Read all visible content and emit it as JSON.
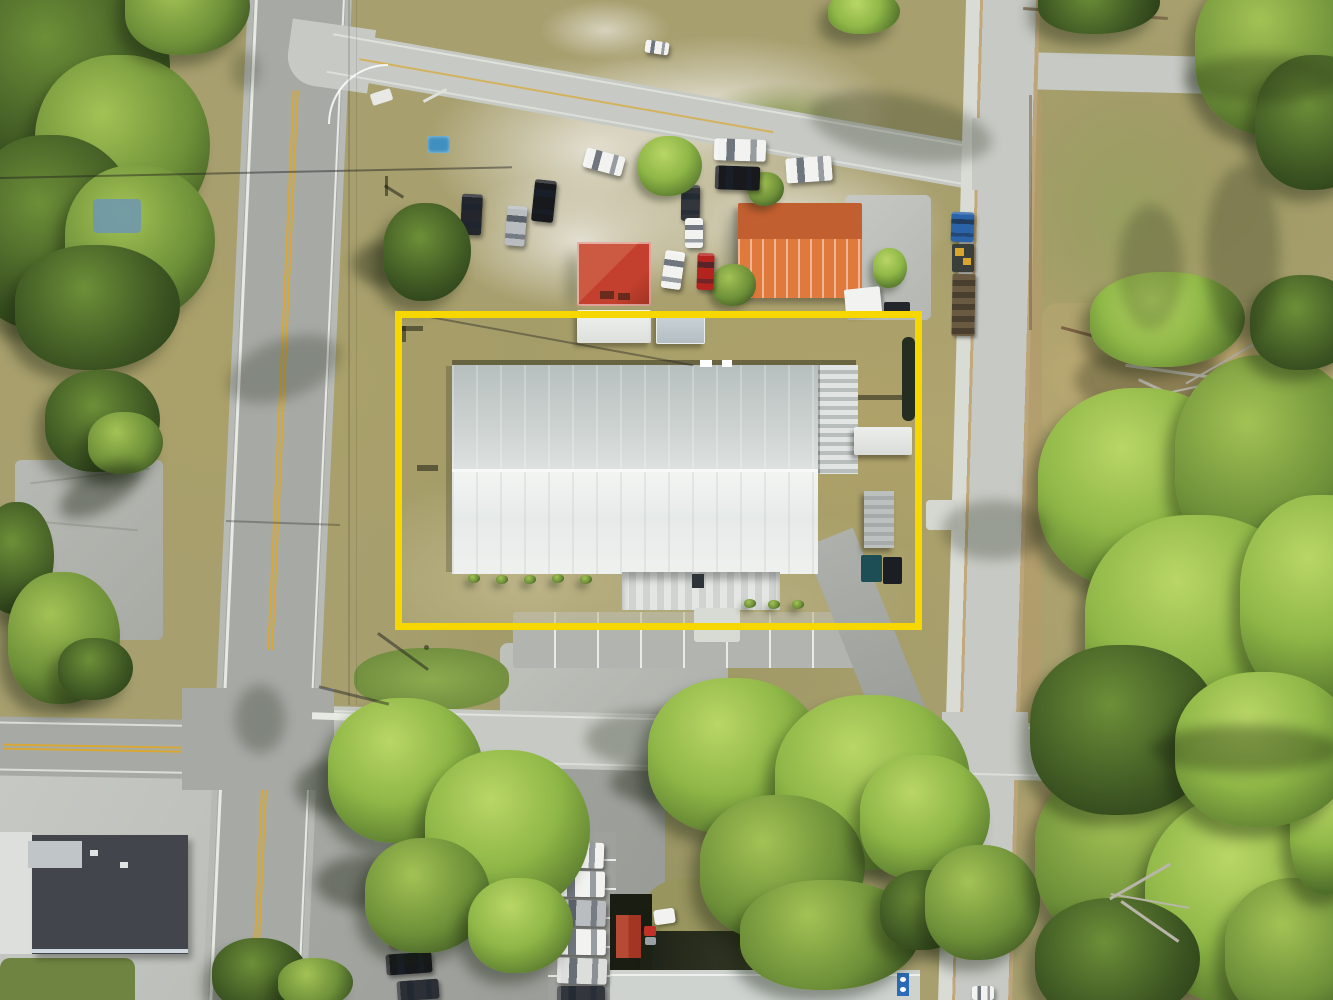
{
  "scene": {
    "type": "aerial-drone-photograph",
    "subject": "commercial property with large white metal warehouse",
    "overlay": "yellow property boundary rectangle"
  },
  "palette": {
    "ground": "#a79f6e",
    "sand": "#e3dfd1",
    "sandDim": "#cfc9b4",
    "roadAsphalt": "#a6a9a4",
    "roadConcrete": "#c7cac4",
    "sidewalk": "#d9dbd5",
    "pavement": "#aeb0ab",
    "pavementLight": "#c8cac4",
    "dirt": "#b79a6c",
    "hay": "#c9ad74",
    "lineYellow": "#d8a832",
    "lineWhite": "#f2f4ee",
    "outlineYellow": "#f6d800",
    "treeLight": "#a3c255",
    "treeMid": "#6d8f38",
    "treeDark": "#3c5522",
    "treeBright": "#8fb747",
    "shadow": "rgba(22,32,14,0.85)",
    "roofWhite": "#eef0ee",
    "roofGrayTop": "#c4cccb",
    "roofRed": "#c3402e",
    "roofRedDark": "#9e3222",
    "roofOrange": "#e07a3c",
    "roofOrangeDark": "#c25f30",
    "roofDark": "#42464c",
    "roofPale": "#ced3d0",
    "carWhite": "#f2f3f1",
    "carSilver": "#b9bdc0",
    "carBlack": "#17191d",
    "carDarkGray": "#33373d",
    "carRed": "#b5231f",
    "truckBlue": "#2b63a8",
    "binTeal": "#1d4d55",
    "poolBlue": "#3f8fc0",
    "tarpBlue": "#6f98ac",
    "signBlue": "#2b6cb8",
    "boxYellow": "#d7a62c",
    "rust": "#6a5a42",
    "rustDark": "#4a3e2e"
  }
}
